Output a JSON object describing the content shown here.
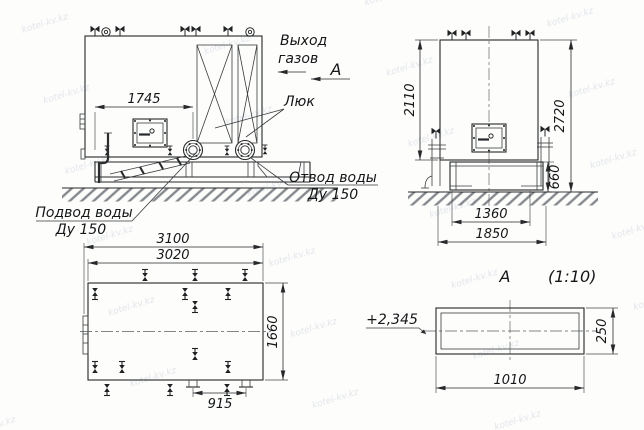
{
  "watermark": {
    "text": "kotel-kv.kz"
  },
  "front_view": {
    "dims": {
      "width_1745": "1745"
    },
    "labels": {
      "gas_outlet_1": "Выход",
      "gas_outlet_2": "газов",
      "view_marker": "А",
      "hatch": "Люк",
      "outlet_1": "Отвод воды",
      "outlet_2": "Ду 150",
      "inlet_1": "Подвод воды",
      "inlet_2": "Ду 150"
    }
  },
  "side_view": {
    "dims": {
      "body_height": "2110",
      "total_height": "2720",
      "base_height": "660",
      "base_width_inner": "1360",
      "base_width_outer": "1850"
    }
  },
  "plan_view": {
    "dims": {
      "length_overall": "3100",
      "length_body": "3020",
      "width": "1660",
      "feet_spacing": "915"
    }
  },
  "detail_view": {
    "title": "А",
    "scale": "(1:10)",
    "elevation_mark": "+2,345",
    "dims": {
      "width": "1010",
      "height": "250"
    }
  }
}
